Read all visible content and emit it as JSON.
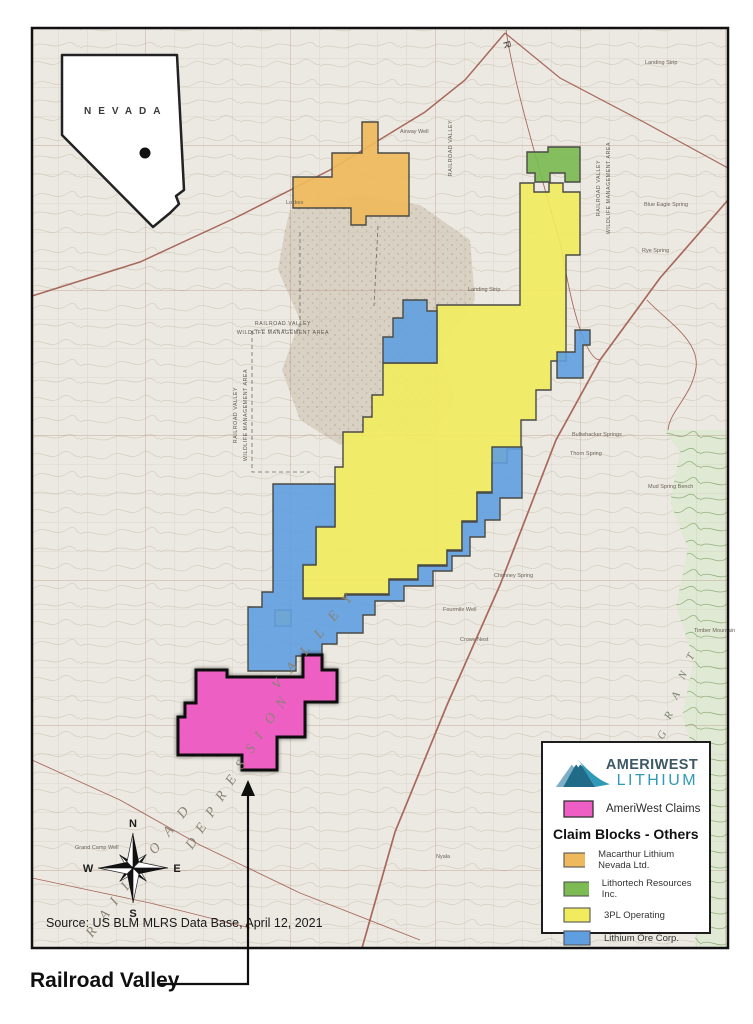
{
  "map": {
    "inset": {
      "state_label": "NEVADA"
    },
    "compass": {
      "n": "N",
      "e": "E",
      "s": "S",
      "w": "W"
    },
    "source_note": "Source:  US BLM MLRS Data Base, April 12, 2021",
    "callout_label": "Railroad Valley",
    "road_letter": "R",
    "big_letters": {
      "railroad": [
        "R",
        "A",
        "I",
        "L",
        "R",
        "O",
        "A",
        "D"
      ],
      "depression": [
        "D",
        "E",
        "P",
        "R",
        "E",
        "S",
        "S",
        "I",
        "O",
        "N"
      ],
      "valley": [
        "V",
        "A",
        "L",
        "L",
        "E",
        "Y"
      ],
      "grant": [
        "G",
        "R",
        "A",
        "N",
        "T"
      ]
    },
    "area_labels": {
      "rv": "RAILROAD VALLEY",
      "wma": "WILDLIFE MANAGEMENT AREA"
    },
    "labels": [
      "Airway Well",
      "Landing Strip",
      "Landing Strip",
      "Bullwhacker Springs",
      "Thorn Spring",
      "Chimney Spring",
      "Fourmile Well",
      "Crows Nest",
      "Mud Spring Bench",
      "Timber Mountain",
      "Blue Eagle Spring",
      "Rye Spring",
      "Grand Camp Well",
      "Nyala",
      "Lockes"
    ]
  },
  "legend": {
    "logo": {
      "line1": "AMERIWEST",
      "line2": "LITHIUM"
    },
    "ameriwest_label": "AmeriWest Claims",
    "others_heading": "Claim Blocks - Others",
    "items": [
      {
        "label": "Macarthur Lithium Nevada Ltd."
      },
      {
        "label": "Lithortech Resources Inc."
      },
      {
        "label": "3PL Operating"
      },
      {
        "label": "Lithium Ore Corp."
      }
    ]
  },
  "colors": {
    "pink": "#ee5ec4",
    "yellow": "#f1ec5d",
    "blue": "#5f9fe0",
    "orange": "#f0b85c",
    "green": "#7cba52",
    "claim_stroke": "#4a4a44",
    "pink_stroke": "#0d0d0d"
  }
}
